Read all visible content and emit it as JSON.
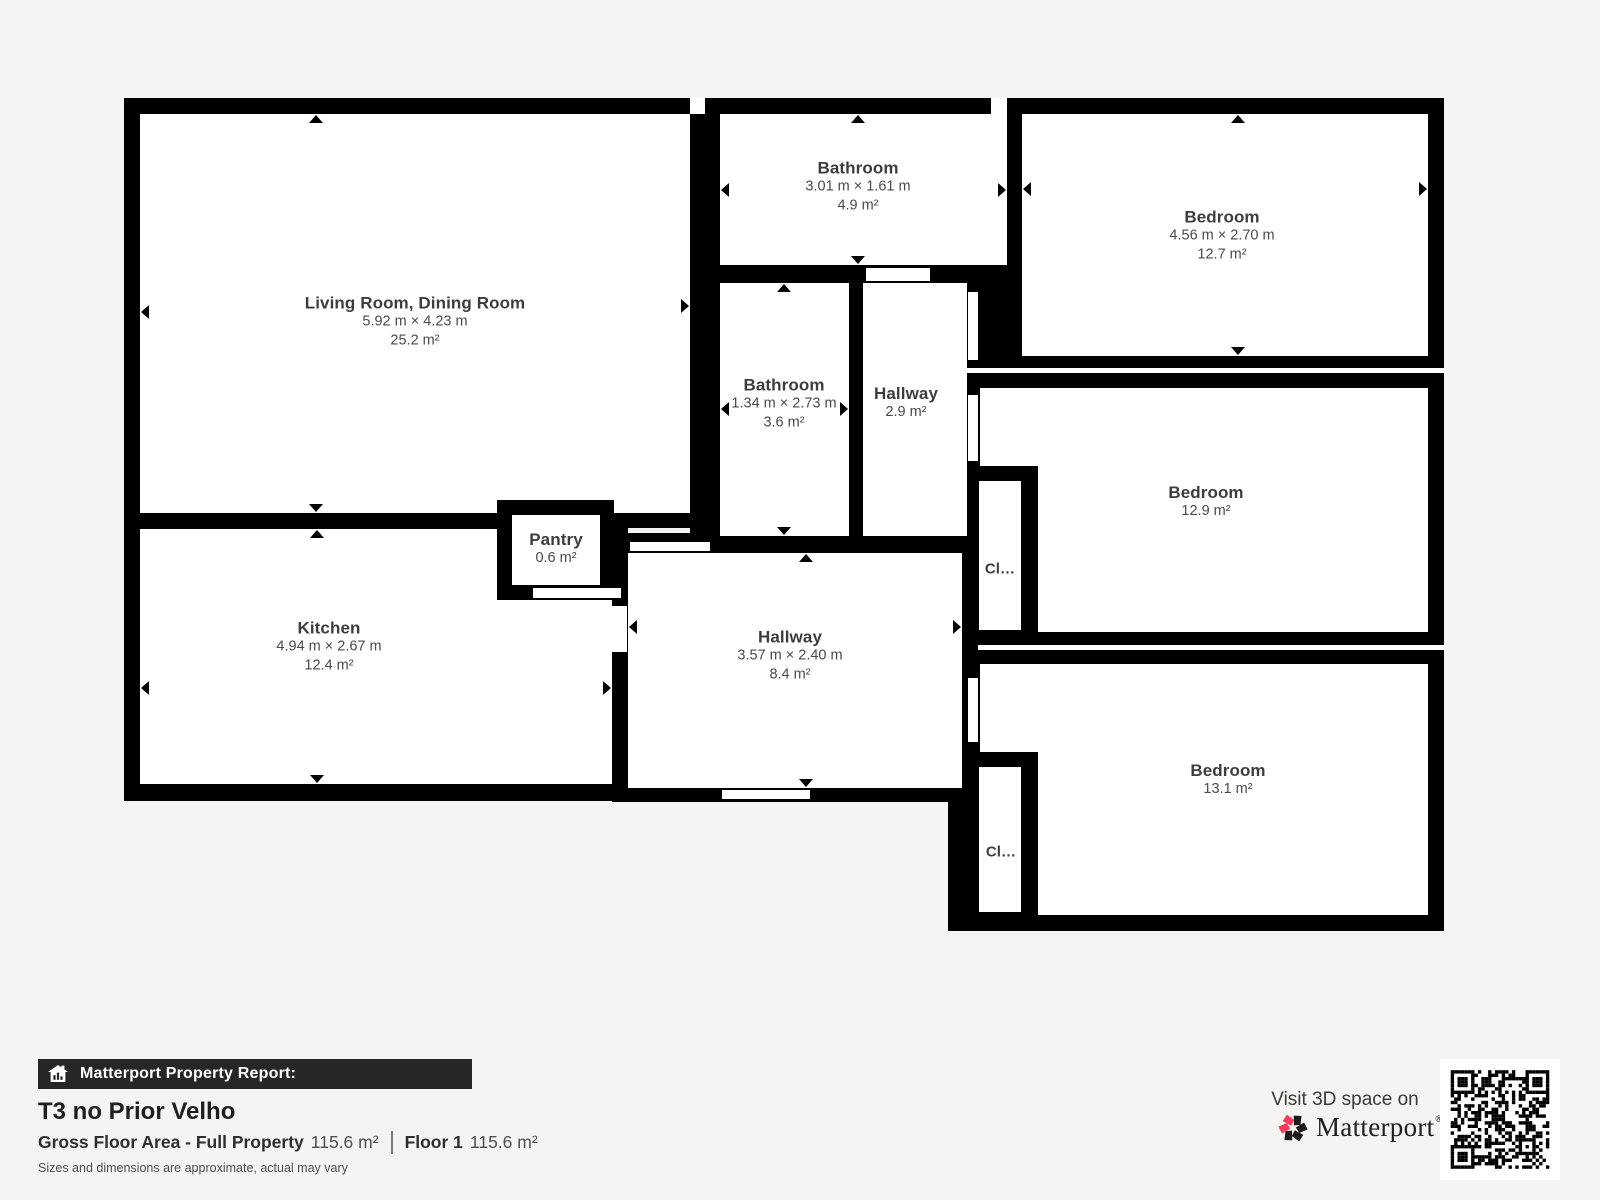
{
  "plan": {
    "rooms": {
      "living": {
        "name": "Living Room, Dining Room",
        "dims": "5.92 m × 4.23 m",
        "area": "25.2 m²"
      },
      "bath_top": {
        "name": "Bathroom",
        "dims": "3.01 m × 1.61 m",
        "area": "4.9 m²"
      },
      "bed_top_right": {
        "name": "Bedroom",
        "dims": "4.56 m × 2.70 m",
        "area": "12.7 m²"
      },
      "bath_mid": {
        "name": "Bathroom",
        "dims": "1.34 m × 2.73 m",
        "area": "3.6 m²"
      },
      "hall_small": {
        "name": "Hallway",
        "area": "2.9 m²"
      },
      "bed_mid_right": {
        "name": "Bedroom",
        "area": "12.9 m²"
      },
      "closet_top": {
        "name": "Cl…"
      },
      "kitchen": {
        "name": "Kitchen",
        "dims": "4.94 m × 2.67 m",
        "area": "12.4 m²"
      },
      "pantry": {
        "name": "Pantry",
        "area": "0.6 m²"
      },
      "hall_main": {
        "name": "Hallway",
        "dims": "3.57 m × 2.40 m",
        "area": "8.4 m²"
      },
      "bed_bottom_right": {
        "name": "Bedroom",
        "area": "13.1 m²"
      },
      "closet_bottom": {
        "name": "Cl…"
      }
    }
  },
  "footer": {
    "report_label": "Matterport Property Report:",
    "title": "T3 no Prior Velho",
    "gross_label": "Gross Floor Area - Full Property",
    "gross_value": "115.6 m²",
    "floor_label": "Floor 1",
    "floor_value": "115.6 m²",
    "disclaimer": "Sizes and dimensions are approximate, actual may vary",
    "visit_text": "Visit 3D space on",
    "brand": "Matterport",
    "brand_mark": "®"
  },
  "colors": {
    "wall": "#000000",
    "floor": "#ffffff",
    "page_bg": "#f5f4f2",
    "accent_pink": "#f93a5c",
    "banner_bg": "#262626"
  },
  "icons": {
    "banner_icon": "house-bar-chart-icon",
    "brand_icon": "matterport-pinwheel-icon",
    "qr": "qr-code"
  }
}
